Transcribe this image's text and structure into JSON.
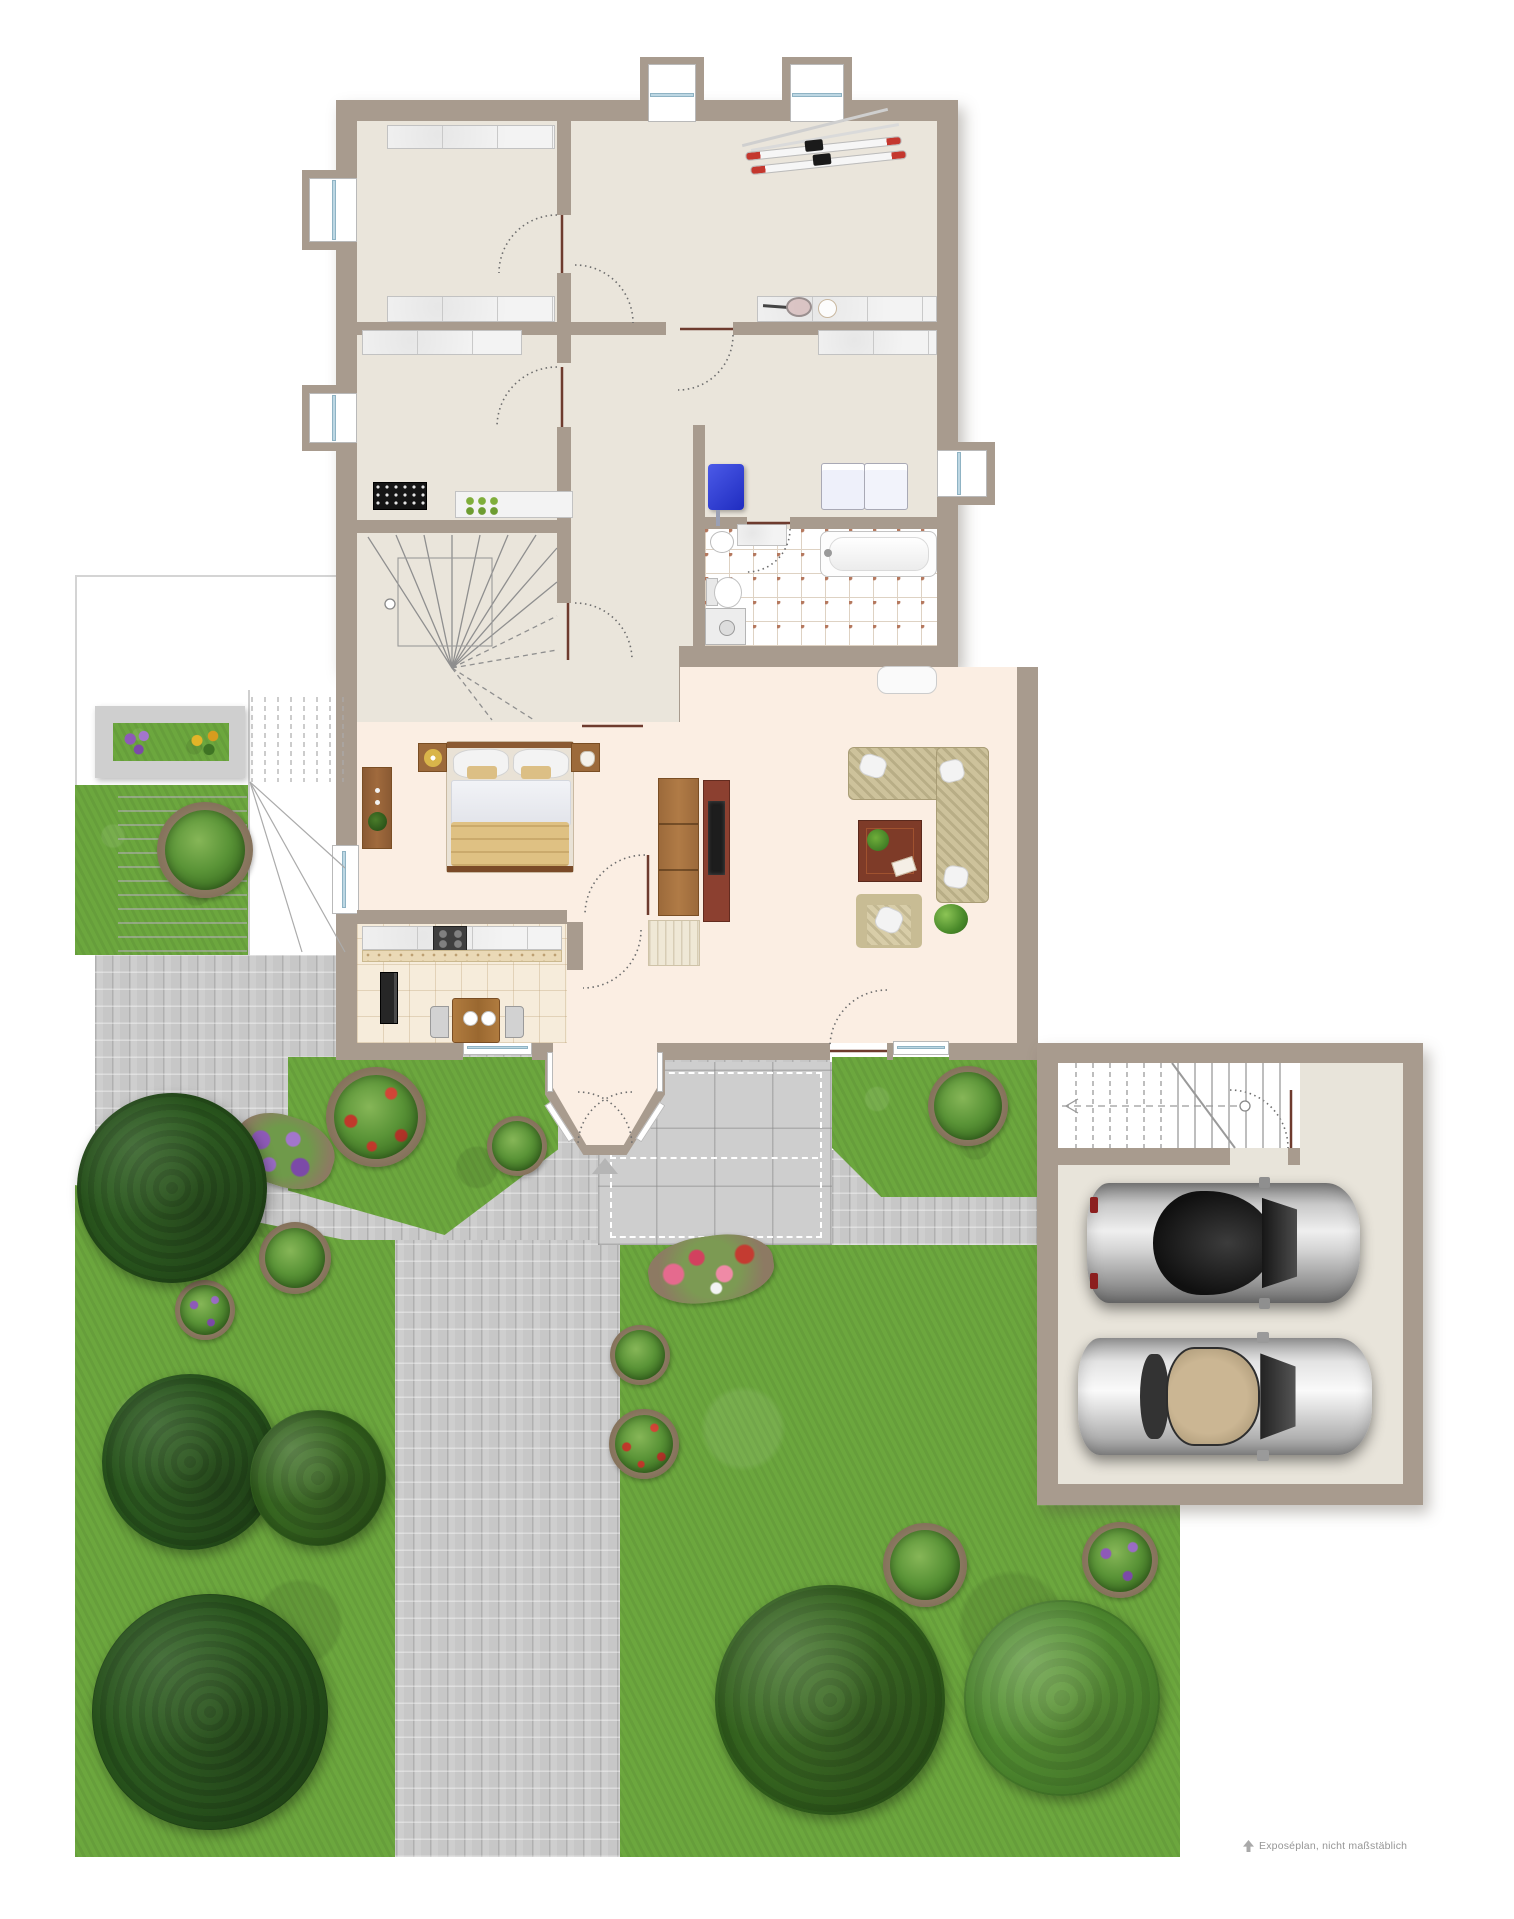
{
  "document": {
    "kind": "real-estate floor plan with garden, driveway and double garage"
  },
  "watermark": {
    "text": "Exposéplan, nicht maßstäblich"
  },
  "palette": {
    "wall": "#a89b8e",
    "room_upper_floor": "#eae5db",
    "room_main_floor": "#fbeee3",
    "kitchen_floor": "#f6ecdb",
    "bathroom_tile_dot": "#b5795f",
    "garage_floor": "#e8e4da",
    "grass": "#6ca73e",
    "pavers": "#c7c7c7",
    "window_glass": "#bdd7e3",
    "furniture_wood": "#9c6a3b",
    "sofa_fabric": "#cdc29b",
    "boiler_accent": "#2b3bd6"
  },
  "inventory": {
    "rooms": [
      "storage-room-1",
      "storage-room-2",
      "hobby-room",
      "stair-room",
      "laundry",
      "bathroom",
      "hallway",
      "bedroom",
      "living-room",
      "kitchen",
      "entrance-bay",
      "garage",
      "terrace",
      "garden",
      "driveway"
    ],
    "furniture": [
      "double-bed",
      "nightstands",
      "dresser",
      "wardrobe",
      "shoe-cabinet",
      "corner-sofa",
      "coffee-table",
      "armchair",
      "tv-sideboard",
      "dining-table",
      "kitchen-counter",
      "stove",
      "fridge",
      "bathtub",
      "toilet",
      "shower",
      "washing-machines",
      "boiler",
      "storage-shelves",
      "wine-rack",
      "skis",
      "tennis-racket"
    ],
    "vehicles": {
      "cars_in_garage": 2
    },
    "vegetation": [
      "trees",
      "bushes",
      "flower-beds",
      "planter-box"
    ]
  }
}
